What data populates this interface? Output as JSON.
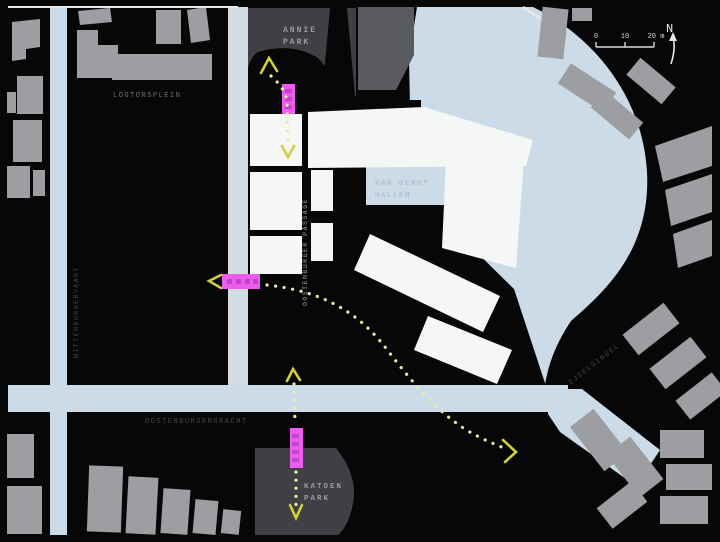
{
  "map": {
    "labels": {
      "park_north_1": "ANNIE",
      "park_north_2": "PARK",
      "square_west": "LOGTORSPLEIN",
      "canal_west": "WITTENBURGERVAART",
      "passage_center": "OOSTENBURGER PASSAGE",
      "halls_1": "VAN GENDT",
      "halls_2": "HALLEN",
      "street_south": "OOSTENBURGERGRACHT",
      "street_east": "IJSELSINGEL",
      "park_south_1": "KATOEN",
      "park_south_2": "PARK"
    },
    "scale_bar": {
      "tick_0": "0",
      "tick_10": "10",
      "tick_20": "20 m",
      "north": "N"
    },
    "colors": {
      "background": "#070707",
      "water": "#ccdbe8",
      "street_light": "#d3dce2",
      "building_gray": "#9c9ea1",
      "building_dark": "#595b60",
      "park_gray": "#3e4045",
      "site_white": "#f5f6f6",
      "route_yellow": "#e9e9aa",
      "arrow_yellow": "#d2ce3e",
      "marker_pink": "#ee5bef",
      "marker_pink_dark": "#c043c8",
      "frame_white": "#e9e9e9",
      "label_gray": "#9a9ca4",
      "label_dim": "#6f717a",
      "label_dark": "#45474f",
      "label_water": "#a9b6c6",
      "scale_white": "#d8d8d8"
    }
  }
}
